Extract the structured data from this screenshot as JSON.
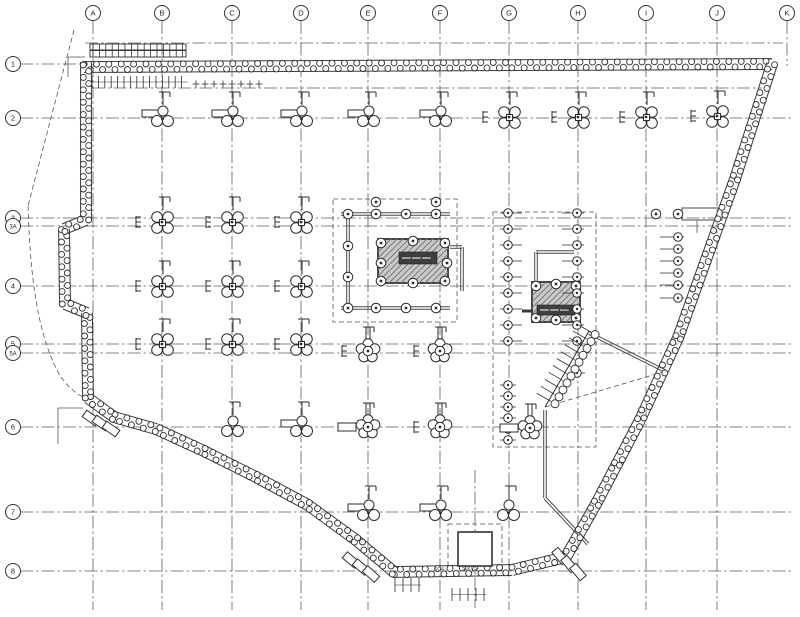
{
  "drawing": {
    "kind": "foundation-piling-plan",
    "bg": "#ffffff",
    "ink": "#2e2e2e",
    "grid_ink": "#5f5f5f",
    "hatch_fill": "#c9c9c9",
    "hatch_line": "#7d7d7d",
    "label_box_fill": "#3e3e3e"
  },
  "grid": {
    "columns": [
      {
        "label": "A",
        "x": 93
      },
      {
        "label": "B",
        "x": 162
      },
      {
        "label": "C",
        "x": 232
      },
      {
        "label": "D",
        "x": 301
      },
      {
        "label": "E",
        "x": 368
      },
      {
        "label": "F",
        "x": 440
      },
      {
        "label": "G",
        "x": 509
      },
      {
        "label": "H",
        "x": 578
      },
      {
        "label": "I",
        "x": 646
      },
      {
        "label": "J",
        "x": 717
      },
      {
        "label": "K",
        "x": 787,
        "short": true
      }
    ],
    "rows": [
      {
        "label": "1",
        "y": 64,
        "x1": 88
      },
      {
        "label": "2",
        "y": 118
      },
      {
        "label": "3",
        "y": 218
      },
      {
        "label": "3A",
        "y": 226
      },
      {
        "label": "4",
        "y": 286
      },
      {
        "label": "5",
        "y": 344
      },
      {
        "label": "5A",
        "y": 353
      },
      {
        "label": "6",
        "y": 427
      },
      {
        "label": "7",
        "y": 512
      },
      {
        "label": "8",
        "y": 571
      }
    ],
    "aux_h": [
      {
        "y": 43,
        "x0": 85,
        "x1": 783
      },
      {
        "y": 88,
        "x0": 92,
        "x1": 762
      }
    ],
    "aux_v": [
      {
        "x": 475,
        "y0": 470,
        "y1": 608
      }
    ]
  },
  "walls": {
    "pile_r": 3.0,
    "spacing": 6.2,
    "edge": 5.4,
    "polylines": [
      [
        [
          84,
          67
        ],
        [
          772,
          64
        ]
      ],
      [
        [
          772,
          64
        ],
        [
          735,
          179
        ],
        [
          678,
          338
        ],
        [
          640,
          420
        ],
        [
          617,
          464
        ],
        [
          596,
          504
        ],
        [
          566,
          557
        ]
      ],
      [
        [
          566,
          557
        ],
        [
          512,
          570
        ],
        [
          394,
          572
        ]
      ],
      [
        [
          394,
          572
        ],
        [
          356,
          540
        ],
        [
          308,
          505
        ],
        [
          256,
          477
        ],
        [
          204,
          451
        ],
        [
          156,
          429
        ],
        [
          114,
          417
        ],
        [
          88,
          398
        ]
      ],
      [
        [
          88,
          398
        ],
        [
          87,
          313
        ],
        [
          65,
          304
        ],
        [
          64,
          229
        ],
        [
          86,
          220
        ],
        [
          86,
          62
        ]
      ]
    ]
  },
  "cores": [
    {
      "name": "core-1",
      "rect": [
        378,
        239,
        70,
        44
      ],
      "label_box": [
        399,
        252,
        38,
        12
      ],
      "piles": [
        [
          381,
          243
        ],
        [
          413,
          241
        ],
        [
          445,
          243
        ],
        [
          381,
          263
        ],
        [
          447,
          263
        ],
        [
          381,
          281
        ],
        [
          413,
          283
        ],
        [
          445,
          281
        ],
        [
          348,
          214
        ],
        [
          376,
          214
        ],
        [
          406,
          214
        ],
        [
          436,
          214
        ],
        [
          348,
          246
        ],
        [
          348,
          277
        ],
        [
          348,
          308
        ],
        [
          376,
          308
        ],
        [
          406,
          308
        ],
        [
          436,
          308
        ],
        [
          376,
          202
        ],
        [
          436,
          202
        ]
      ]
    },
    {
      "name": "core-2",
      "rect": [
        532,
        282,
        48,
        40
      ],
      "label_box": [
        537,
        305,
        38,
        10
      ],
      "piles": [
        [
          536,
          286
        ],
        [
          556,
          284
        ],
        [
          576,
          286
        ],
        [
          536,
          318
        ],
        [
          556,
          320
        ],
        [
          576,
          318
        ],
        [
          656,
          214
        ],
        [
          678,
          214
        ]
      ]
    }
  ],
  "beams": [
    [
      341,
      214,
      450,
      214
    ],
    [
      348,
      214,
      348,
      308
    ],
    [
      341,
      308,
      450,
      308
    ],
    [
      450,
      247,
      462,
      247
    ],
    [
      462,
      247,
      462,
      291
    ],
    [
      413,
      241,
      413,
      283
    ],
    [
      381,
      262,
      447,
      262
    ],
    [
      536,
      252,
      574,
      252
    ],
    [
      536,
      252,
      536,
      282
    ],
    [
      589,
      333,
      665,
      371
    ],
    [
      545,
      410,
      545,
      498
    ],
    [
      545,
      498,
      588,
      544
    ]
  ],
  "thick_ticks": [
    [
      522,
      311,
      532,
      311
    ]
  ],
  "rect_beams": [
    [
      682,
      208,
      40,
      12
    ]
  ],
  "thin_lines": [
    [
      697,
      220,
      697,
      233
    ],
    [
      58,
      408,
      83,
      408
    ],
    [
      58,
      408,
      58,
      444
    ],
    [
      68,
      57,
      85,
      57
    ],
    [
      68,
      57,
      68,
      77
    ]
  ],
  "pile_rows": [
    {
      "x": 508,
      "ys": [
        213,
        229,
        245,
        261,
        277,
        293,
        309,
        325,
        341
      ],
      "t0": -8,
      "t1": 14
    },
    {
      "x": 508,
      "ys": [
        385,
        396,
        407,
        418,
        429,
        440
      ],
      "t0": -8,
      "t1": 8
    },
    {
      "x": 577,
      "ys": [
        213,
        229,
        245,
        261,
        277,
        293,
        309,
        325,
        341
      ],
      "t0": -15,
      "t1": 7
    },
    {
      "x": 577,
      "ys": [
        373
      ],
      "t0": -8,
      "t1": 8
    },
    {
      "x": 678,
      "ys": [
        237,
        249,
        261,
        273,
        285,
        298
      ],
      "t0": -18,
      "t1": 6
    }
  ],
  "caps": [
    {
      "x": 162,
      "y": 117,
      "t": "tr"
    },
    {
      "x": 232,
      "y": 117,
      "t": "tr"
    },
    {
      "x": 301,
      "y": 117,
      "t": "tr"
    },
    {
      "x": 368,
      "y": 117,
      "t": "tr"
    },
    {
      "x": 440,
      "y": 117,
      "t": "tr"
    },
    {
      "x": 509,
      "y": 117,
      "t": "q"
    },
    {
      "x": 578,
      "y": 117,
      "t": "q"
    },
    {
      "x": 646,
      "y": 117,
      "t": "q"
    },
    {
      "x": 717,
      "y": 116,
      "t": "q"
    },
    {
      "x": 162,
      "y": 222,
      "t": "q"
    },
    {
      "x": 232,
      "y": 222,
      "t": "q"
    },
    {
      "x": 301,
      "y": 222,
      "t": "q"
    },
    {
      "x": 162,
      "y": 286,
      "t": "q"
    },
    {
      "x": 232,
      "y": 286,
      "t": "q"
    },
    {
      "x": 301,
      "y": 286,
      "t": "q"
    },
    {
      "x": 162,
      "y": 344,
      "t": "q"
    },
    {
      "x": 232,
      "y": 344,
      "t": "q"
    },
    {
      "x": 301,
      "y": 344,
      "t": "q"
    },
    {
      "x": 368,
      "y": 351,
      "t": "fe"
    },
    {
      "x": 440,
      "y": 351,
      "t": "fe"
    },
    {
      "x": 232,
      "y": 427,
      "t": "t3"
    },
    {
      "x": 301,
      "y": 427,
      "t": "tr"
    },
    {
      "x": 368,
      "y": 427,
      "t": "fr"
    },
    {
      "x": 440,
      "y": 427,
      "t": "fe"
    },
    {
      "x": 530,
      "y": 428,
      "t": "fr"
    },
    {
      "x": 368,
      "y": 511,
      "t": "tr"
    },
    {
      "x": 440,
      "y": 511,
      "t": "tr"
    },
    {
      "x": 508,
      "y": 511,
      "t": "t3"
    }
  ],
  "dashed": {
    "rects": [
      [
        333,
        199,
        124,
        123
      ],
      [
        493,
        212,
        103,
        235
      ],
      [
        448,
        524,
        54,
        47
      ]
    ],
    "lines": [
      [
        74,
        30,
        28,
        206
      ],
      [
        545,
        407,
        663,
        372
      ]
    ],
    "curve": "M28,206 C30,270 36,330 58,372 C66,386 76,394 88,400"
  },
  "solid_rects": [
    [
      458,
      532,
      34,
      34
    ]
  ],
  "ladder": {
    "p0": [
      589,
      331
    ],
    "p1": [
      545,
      407
    ],
    "step": 8,
    "rung": 16,
    "pile_r": 4,
    "pile_off": -7
  },
  "battens": [
    {
      "cx": 91,
      "cy": 418,
      "rot": 35
    },
    {
      "cx": 101,
      "cy": 423,
      "rot": 35
    },
    {
      "cx": 111,
      "cy": 429,
      "rot": 35
    },
    {
      "cx": 351,
      "cy": 560,
      "rot": 40
    },
    {
      "cx": 361,
      "cy": 567,
      "rot": 40
    },
    {
      "cx": 371,
      "cy": 574,
      "rot": 42
    },
    {
      "cx": 560,
      "cy": 556,
      "rot": 50
    },
    {
      "cx": 569,
      "cy": 564,
      "rot": 50
    },
    {
      "cx": 578,
      "cy": 572,
      "rot": 50
    }
  ],
  "combs": [
    {
      "x0": 92,
      "x1": 188,
      "step": 6.4,
      "y0": 76,
      "y1": 88
    },
    {
      "x0": 93,
      "x1": 185,
      "step": 6.4,
      "y0": 44,
      "y1": 57
    },
    {
      "x0": 395,
      "x1": 421,
      "step": 8,
      "y0": 578,
      "y1": 592
    },
    {
      "x0": 452,
      "x1": 486,
      "step": 8,
      "y0": 588,
      "y1": 601
    }
  ],
  "plus_row": {
    "x0": 196,
    "x1": 260,
    "step": 9,
    "y": 84,
    "size": 3.5
  },
  "top_band_rects": [
    [
      90,
      44,
      96,
      6
    ],
    [
      90,
      50.5,
      96,
      6.5
    ]
  ],
  "texts": [
    {
      "x": 434,
      "y": 571,
      "s": "SC4"
    },
    {
      "x": 462,
      "y": 570,
      "s": "50x 75"
    }
  ]
}
